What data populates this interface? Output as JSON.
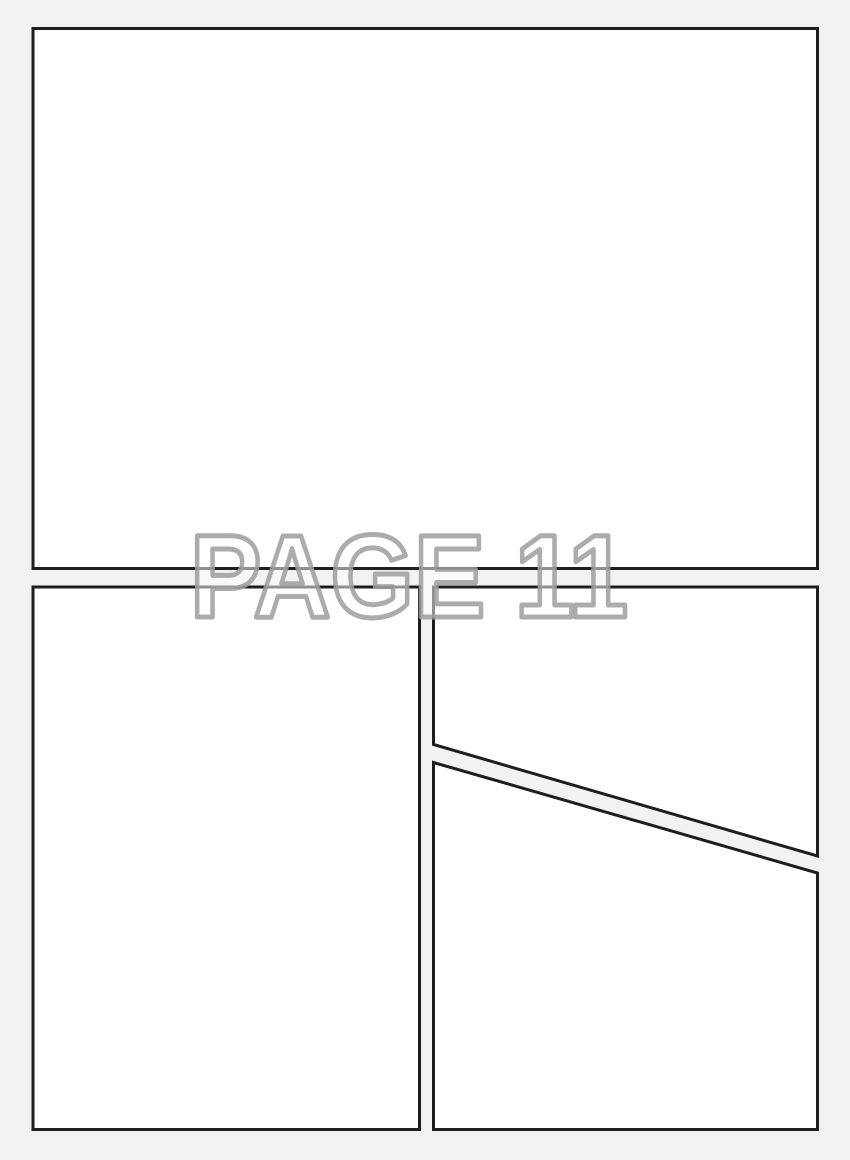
{
  "page": {
    "label": "PAGE 11",
    "panel_count": 4
  },
  "panels": [
    {
      "name": "top-panel",
      "shape": "rectangle",
      "position": "top full-width"
    },
    {
      "name": "bottom-left-panel",
      "shape": "rectangle",
      "position": "bottom left"
    },
    {
      "name": "top-right-panel",
      "shape": "quadrilateral",
      "position": "bottom-right upper, diagonal bottom edge"
    },
    {
      "name": "bottom-right-panel",
      "shape": "quadrilateral",
      "position": "bottom-right lower, diagonal top edge"
    }
  ],
  "colors": {
    "background": "#f2f2f2",
    "panel-fill": "#ffffff",
    "border-color": "#1e1e1e",
    "watermark-outline": "#9e9e9e"
  }
}
